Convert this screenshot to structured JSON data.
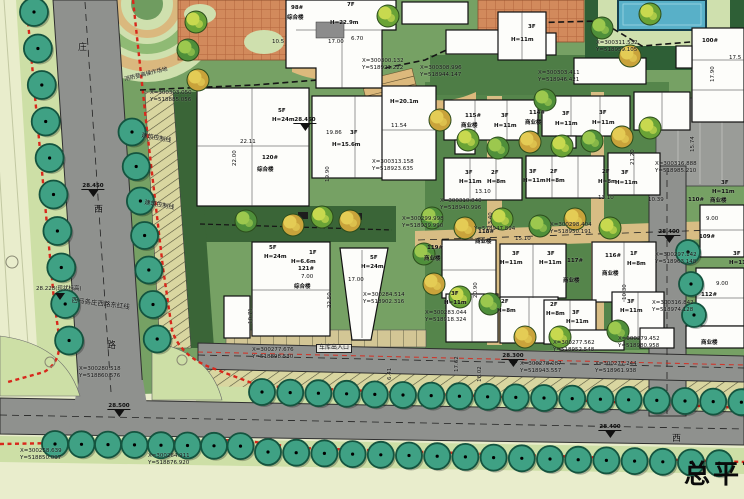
{
  "title": {
    "text": "总平面图"
  },
  "colors": {
    "background": "#e9edcc",
    "site_green": "#76a164",
    "dark_green": "#3a6537",
    "road_gray": "#8f918e",
    "path_tan": "#d8bd84",
    "plaza_orange": "#d28a5c",
    "tree_teal": "#3fa184",
    "red_line": "#d8281c",
    "pool_blue": "#58b0c8",
    "building_white": "#fdfdfa"
  },
  "labels": [
    {
      "k": "road",
      "t": "庄",
      "x": 78,
      "y": 44,
      "s": 9
    },
    {
      "k": "road",
      "t": "西",
      "x": 94,
      "y": 206,
      "s": 9
    },
    {
      "k": "road",
      "t": "路",
      "x": 107,
      "y": 342,
      "s": 9
    },
    {
      "k": "road",
      "t": "西",
      "x": 672,
      "y": 435,
      "s": 9
    },
    {
      "k": "note",
      "t": "西马各庄西路东红线",
      "x": 72,
      "y": 297,
      "r": 7,
      "s": 6.5
    },
    {
      "k": "note",
      "t": "建筑控制线",
      "x": 145,
      "y": 200,
      "r": 10,
      "s": 6
    },
    {
      "k": "note",
      "t": "建筑控制线",
      "x": 142,
      "y": 133,
      "r": 10,
      "s": 6
    },
    {
      "k": "note",
      "t": "消防登高操作场地",
      "x": 124,
      "y": 77,
      "r": -14,
      "s": 5.5
    },
    {
      "k": "note",
      "t": "28.228(现状标高)",
      "x": 36,
      "y": 286,
      "s": 5.5
    },
    {
      "k": "box",
      "t": "车库出入口",
      "x": 316,
      "y": 344,
      "s": 6
    },
    {
      "k": "bld",
      "t": "98#",
      "x": 291,
      "y": 5
    },
    {
      "k": "bld",
      "t": "综合楼",
      "x": 287,
      "y": 15
    },
    {
      "k": "bld",
      "t": "7F",
      "x": 347,
      "y": 2
    },
    {
      "k": "bld",
      "t": "H=22.9m",
      "x": 330,
      "y": 20
    },
    {
      "k": "bld",
      "t": "120#",
      "x": 262,
      "y": 155
    },
    {
      "k": "bld",
      "t": "综合楼",
      "x": 257,
      "y": 167
    },
    {
      "k": "bld",
      "t": "5F",
      "x": 278,
      "y": 108
    },
    {
      "k": "bld",
      "t": "H=24m",
      "x": 272,
      "y": 117
    },
    {
      "k": "bld",
      "t": "3F",
      "x": 350,
      "y": 130
    },
    {
      "k": "bld",
      "t": "H=15.6m",
      "x": 332,
      "y": 142
    },
    {
      "k": "bld",
      "t": "H=20.1m",
      "x": 390,
      "y": 99
    },
    {
      "k": "bld",
      "t": "5F",
      "x": 269,
      "y": 245
    },
    {
      "k": "bld",
      "t": "H=24m",
      "x": 264,
      "y": 254
    },
    {
      "k": "bld",
      "t": "1F",
      "x": 309,
      "y": 250
    },
    {
      "k": "bld",
      "t": "H=6.6m",
      "x": 291,
      "y": 259
    },
    {
      "k": "bld",
      "t": "121#",
      "x": 298,
      "y": 266
    },
    {
      "k": "bld",
      "t": "综合楼",
      "x": 294,
      "y": 284
    },
    {
      "k": "bld",
      "t": "5F",
      "x": 370,
      "y": 255
    },
    {
      "k": "bld",
      "t": "H=24m",
      "x": 361,
      "y": 264
    },
    {
      "k": "bld",
      "t": "115#",
      "x": 465,
      "y": 113
    },
    {
      "k": "bld",
      "t": "商业楼",
      "x": 461,
      "y": 123
    },
    {
      "k": "bld",
      "t": "3F",
      "x": 501,
      "y": 113
    },
    {
      "k": "bld",
      "t": "H=11m",
      "x": 494,
      "y": 123
    },
    {
      "k": "bld",
      "t": "114#",
      "x": 529,
      "y": 110
    },
    {
      "k": "bld",
      "t": "商业楼",
      "x": 525,
      "y": 120
    },
    {
      "k": "bld",
      "t": "3F",
      "x": 562,
      "y": 111
    },
    {
      "k": "bld",
      "t": "H=11m",
      "x": 555,
      "y": 121
    },
    {
      "k": "bld",
      "t": "3F",
      "x": 599,
      "y": 110
    },
    {
      "k": "bld",
      "t": "H=11m",
      "x": 592,
      "y": 120
    },
    {
      "k": "bld",
      "t": "3F",
      "x": 528,
      "y": 24
    },
    {
      "k": "bld",
      "t": "H=11m",
      "x": 511,
      "y": 37
    },
    {
      "k": "bld",
      "t": "3F",
      "x": 465,
      "y": 170
    },
    {
      "k": "bld",
      "t": "H=11m",
      "x": 459,
      "y": 179
    },
    {
      "k": "bld",
      "t": "2F",
      "x": 491,
      "y": 170
    },
    {
      "k": "bld",
      "t": "H=8m",
      "x": 487,
      "y": 179
    },
    {
      "k": "bld",
      "t": "3F",
      "x": 529,
      "y": 169
    },
    {
      "k": "bld",
      "t": "H=11m",
      "x": 523,
      "y": 178
    },
    {
      "k": "bld",
      "t": "2F",
      "x": 550,
      "y": 169
    },
    {
      "k": "bld",
      "t": "H=8m",
      "x": 546,
      "y": 178
    },
    {
      "k": "bld",
      "t": "2F",
      "x": 602,
      "y": 169
    },
    {
      "k": "bld",
      "t": "H=8m",
      "x": 598,
      "y": 179
    },
    {
      "k": "bld",
      "t": "3F",
      "x": 621,
      "y": 170
    },
    {
      "k": "bld",
      "t": "H=11m",
      "x": 615,
      "y": 180
    },
    {
      "k": "bld",
      "t": "119#",
      "x": 427,
      "y": 245
    },
    {
      "k": "bld",
      "t": "商业楼",
      "x": 424,
      "y": 256
    },
    {
      "k": "bld",
      "t": "3F",
      "x": 451,
      "y": 291
    },
    {
      "k": "bld",
      "t": "H=11m",
      "x": 444,
      "y": 300
    },
    {
      "k": "bld",
      "t": "3F",
      "x": 512,
      "y": 251
    },
    {
      "k": "bld",
      "t": "H=11m",
      "x": 500,
      "y": 260
    },
    {
      "k": "bld",
      "t": "3F",
      "x": 547,
      "y": 251
    },
    {
      "k": "bld",
      "t": "H=11m",
      "x": 539,
      "y": 260
    },
    {
      "k": "bld",
      "t": "117#",
      "x": 567,
      "y": 258
    },
    {
      "k": "bld",
      "t": "商业楼",
      "x": 563,
      "y": 278
    },
    {
      "k": "bld",
      "t": "116#",
      "x": 605,
      "y": 253
    },
    {
      "k": "bld",
      "t": "1F",
      "x": 630,
      "y": 251
    },
    {
      "k": "bld",
      "t": "H=8m",
      "x": 627,
      "y": 261
    },
    {
      "k": "bld",
      "t": "商业楼",
      "x": 602,
      "y": 271
    },
    {
      "k": "bld",
      "t": "118#",
      "x": 478,
      "y": 229
    },
    {
      "k": "bld",
      "t": "商业楼",
      "x": 475,
      "y": 239
    },
    {
      "k": "bld",
      "t": "2F",
      "x": 501,
      "y": 299
    },
    {
      "k": "bld",
      "t": "H=8m",
      "x": 497,
      "y": 308
    },
    {
      "k": "bld",
      "t": "2F",
      "x": 550,
      "y": 302
    },
    {
      "k": "bld",
      "t": "H=8m",
      "x": 546,
      "y": 311
    },
    {
      "k": "bld",
      "t": "3F",
      "x": 572,
      "y": 310
    },
    {
      "k": "bld",
      "t": "H=11m",
      "x": 566,
      "y": 319
    },
    {
      "k": "bld",
      "t": "3F",
      "x": 627,
      "y": 299
    },
    {
      "k": "bld",
      "t": "H=11m",
      "x": 620,
      "y": 308
    },
    {
      "k": "bld",
      "t": "100#",
      "x": 702,
      "y": 38
    },
    {
      "k": "bld",
      "t": "3F",
      "x": 721,
      "y": 180
    },
    {
      "k": "bld",
      "t": "H=11m",
      "x": 712,
      "y": 189
    },
    {
      "k": "bld",
      "t": "110#",
      "x": 688,
      "y": 197
    },
    {
      "k": "bld",
      "t": "商业楼",
      "x": 710,
      "y": 198
    },
    {
      "k": "bld",
      "t": "109#",
      "x": 699,
      "y": 234
    },
    {
      "k": "bld",
      "t": "112#",
      "x": 701,
      "y": 292
    },
    {
      "k": "bld",
      "t": "3F",
      "x": 733,
      "y": 251
    },
    {
      "k": "bld",
      "t": "H=11m",
      "x": 729,
      "y": 260
    },
    {
      "k": "bld",
      "t": "商业楼",
      "x": 701,
      "y": 340
    },
    {
      "k": "dim",
      "t": "10.5",
      "x": 272,
      "y": 39
    },
    {
      "k": "dim",
      "t": "17.00",
      "x": 328,
      "y": 39
    },
    {
      "k": "dim",
      "t": "6.70",
      "x": 351,
      "y": 36
    },
    {
      "k": "dim",
      "t": "22.11",
      "x": 240,
      "y": 139
    },
    {
      "k": "dim",
      "t": "22.00",
      "x": 232,
      "y": 166,
      "r": -90
    },
    {
      "k": "dim",
      "t": "19.86",
      "x": 326,
      "y": 130
    },
    {
      "k": "dim",
      "t": "19.90",
      "x": 325,
      "y": 182,
      "r": -90
    },
    {
      "k": "dim",
      "t": "11.54",
      "x": 391,
      "y": 123
    },
    {
      "k": "dim",
      "t": "7.00",
      "x": 301,
      "y": 274
    },
    {
      "k": "dim",
      "t": "17.00",
      "x": 348,
      "y": 277
    },
    {
      "k": "dim",
      "t": "22.50",
      "x": 327,
      "y": 308,
      "r": -90
    },
    {
      "k": "dim",
      "t": "10.71",
      "x": 248,
      "y": 324,
      "r": -90
    },
    {
      "k": "dim",
      "t": "13.40",
      "x": 488,
      "y": 228,
      "r": -90
    },
    {
      "k": "dim",
      "t": "13.10",
      "x": 598,
      "y": 195
    },
    {
      "k": "dim",
      "t": "13.10",
      "x": 475,
      "y": 189
    },
    {
      "k": "dim",
      "t": "15.10",
      "x": 515,
      "y": 236
    },
    {
      "k": "dim",
      "t": "10.39",
      "x": 648,
      "y": 197
    },
    {
      "k": "dim",
      "t": "21.20",
      "x": 630,
      "y": 165,
      "r": -90
    },
    {
      "k": "dim",
      "t": "15.74",
      "x": 690,
      "y": 152,
      "r": -90
    },
    {
      "k": "dim",
      "t": "17.90",
      "x": 710,
      "y": 82,
      "r": -90
    },
    {
      "k": "dim",
      "t": "17.5",
      "x": 729,
      "y": 55
    },
    {
      "k": "dim",
      "t": "20.90",
      "x": 473,
      "y": 298,
      "r": -90
    },
    {
      "k": "dim",
      "t": "10.30",
      "x": 622,
      "y": 300,
      "r": -90
    },
    {
      "k": "dim",
      "t": "16.02",
      "x": 477,
      "y": 382,
      "r": -90
    },
    {
      "k": "dim",
      "t": "17.62",
      "x": 454,
      "y": 372,
      "r": -90
    },
    {
      "k": "dim",
      "t": "6.41",
      "x": 387,
      "y": 380,
      "r": -90
    },
    {
      "k": "dim",
      "t": "9.00",
      "x": 706,
      "y": 216
    },
    {
      "k": "dim",
      "t": "9.00",
      "x": 716,
      "y": 281
    },
    {
      "k": "coord",
      "t": "X=300303.050",
      "t2": "Y=518885.056",
      "x": 150,
      "y": 90
    },
    {
      "k": "coord",
      "t": "X=300300.132",
      "t2": "Y=518921.222",
      "x": 362,
      "y": 58
    },
    {
      "k": "coord",
      "t": "X=300308.996",
      "t2": "Y=518944.147",
      "x": 420,
      "y": 65
    },
    {
      "k": "coord",
      "t": "X=300313.158",
      "t2": "Y=518923.635",
      "x": 372,
      "y": 159
    },
    {
      "k": "coord",
      "t": "X=300311.532",
      "t2": "Y=518959.105",
      "x": 596,
      "y": 40
    },
    {
      "k": "coord",
      "t": "X=300303.411",
      "t2": "Y=518946.421",
      "x": 538,
      "y": 70
    },
    {
      "k": "coord",
      "t": "X=300310.840",
      "t2": "Y=518940.996",
      "x": 440,
      "y": 198
    },
    {
      "k": "coord",
      "t": "X=300299.998",
      "t2": "Y=518939.990",
      "x": 402,
      "y": 216
    },
    {
      "k": "coord",
      "t": "Y=518947.894",
      "x": 474,
      "y": 226
    },
    {
      "k": "coord",
      "t": "X=300298.404",
      "t2": "Y=518950.191",
      "x": 550,
      "y": 222
    },
    {
      "k": "coord",
      "t": "X=300297.142",
      "t2": "Y=518963.148",
      "x": 655,
      "y": 252
    },
    {
      "k": "coord",
      "t": "X=300316.842",
      "t2": "Y=518974.128",
      "x": 652,
      "y": 300
    },
    {
      "k": "coord",
      "t": "X=300316.888",
      "t2": "Y=518985.210",
      "x": 655,
      "y": 161
    },
    {
      "k": "coord",
      "t": "X=300280.518",
      "t2": "Y=518860.576",
      "x": 79,
      "y": 366
    },
    {
      "k": "coord",
      "t": "X=300258.639",
      "t2": "Y=518850.097",
      "x": 20,
      "y": 448
    },
    {
      "k": "coord",
      "t": "X=300264.911",
      "t2": "Y=518876.920",
      "x": 148,
      "y": 453
    },
    {
      "k": "coord",
      "t": "X=300277.676",
      "t2": "Y=518898.530",
      "x": 252,
      "y": 347
    },
    {
      "k": "coord",
      "t": "X=300278.087",
      "t2": "Y=518943.557",
      "x": 520,
      "y": 361
    },
    {
      "k": "coord",
      "t": "X=300277.244",
      "t2": "Y=518961.938",
      "x": 595,
      "y": 361
    },
    {
      "k": "coord",
      "t": "X=300279.452",
      "t2": "Y=518980.958",
      "x": 618,
      "y": 336
    },
    {
      "k": "coord",
      "t": "X=300277.562",
      "t2": "Y=518952.548",
      "x": 553,
      "y": 340
    },
    {
      "k": "coord",
      "t": "X=300283.044",
      "t2": "Y=518918.324",
      "x": 425,
      "y": 310
    },
    {
      "k": "coord",
      "t": "X=300284.514",
      "t2": "Y=518902.316",
      "x": 363,
      "y": 292
    }
  ],
  "elevation_markers": [
    {
      "t": "28.450",
      "x": 93,
      "y": 172
    },
    {
      "t": "28.450",
      "x": 305,
      "y": 106
    },
    {
      "t": "28.500",
      "x": 119,
      "y": 392
    },
    {
      "t": "28.300",
      "x": 513,
      "y": 342
    },
    {
      "t": "28.400",
      "x": 610,
      "y": 413
    },
    {
      "t": "28.400",
      "x": 669,
      "y": 218
    },
    {
      "t": "",
      "x": 60,
      "y": 294
    }
  ]
}
